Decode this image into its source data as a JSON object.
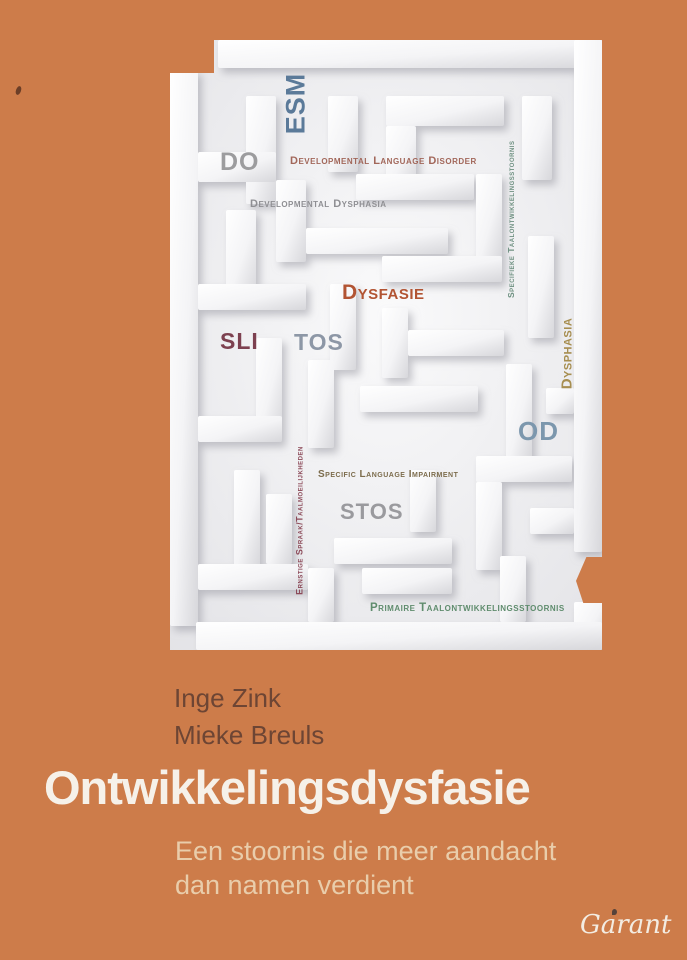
{
  "cover": {
    "background_color": "#cd7c4a",
    "title": "Ontwikkelingsdysfasie",
    "title_color": "#f6f1e9",
    "subtitle": {
      "line1": "Een stoornis die meer aandacht",
      "line2": "dan namen verdient",
      "color": "#e9cdab"
    },
    "authors": {
      "line1": "Inge Zink",
      "line2": "Mieke Breuls",
      "color": "#6d4534"
    },
    "publisher_logo": "Garant"
  },
  "maze": {
    "description": "white 3D paper maze illustration containing synonyms for developmental dysphasia",
    "labels": [
      {
        "id": "esm",
        "text": "ESM",
        "color": "#5b7a99",
        "orientation": "vertical"
      },
      {
        "id": "do",
        "text": "DO",
        "color": "#9c9c9e",
        "orientation": "horizontal"
      },
      {
        "id": "developmental-language-disorder",
        "text": "Developmental Language Disorder",
        "color": "#a2675a",
        "orientation": "horizontal"
      },
      {
        "id": "developmental-dysphasia",
        "text": "Developmental Dysphasia",
        "color": "#8f8f93",
        "orientation": "horizontal"
      },
      {
        "id": "dysfasie",
        "text": "Dysfasie",
        "color": "#b25433",
        "orientation": "horizontal"
      },
      {
        "id": "sli",
        "text": "SLI",
        "color": "#7d4150",
        "orientation": "horizontal"
      },
      {
        "id": "tos",
        "text": "TOS",
        "color": "#8d97a6",
        "orientation": "horizontal"
      },
      {
        "id": "specifieke-taalontwikkelingsstoornis",
        "text": "Specifieke Taalontwikkelingsstoornis",
        "color": "#6f9182",
        "orientation": "vertical"
      },
      {
        "id": "dysphasia",
        "text": "Dysphasia",
        "color": "#a78e50",
        "orientation": "vertical"
      },
      {
        "id": "od",
        "text": "OD",
        "color": "#7c97ad",
        "orientation": "horizontal"
      },
      {
        "id": "specific-language-impairment",
        "text": "Specific Language Impairment",
        "color": "#7c6c4c",
        "orientation": "horizontal"
      },
      {
        "id": "stos",
        "text": "STOS",
        "color": "#9a9a9e",
        "orientation": "horizontal"
      },
      {
        "id": "ernstige-spraak-taalmoeilijkheden",
        "text": "Ernstige Spraak/Taalmoeilijkheden",
        "color": "#8c4a59",
        "orientation": "vertical"
      },
      {
        "id": "primaire-taalontwikkelingsstoornis",
        "text": "Primaire Taalontwikkelingsstoornis",
        "color": "#5f8c6d",
        "orientation": "horizontal"
      }
    ]
  }
}
